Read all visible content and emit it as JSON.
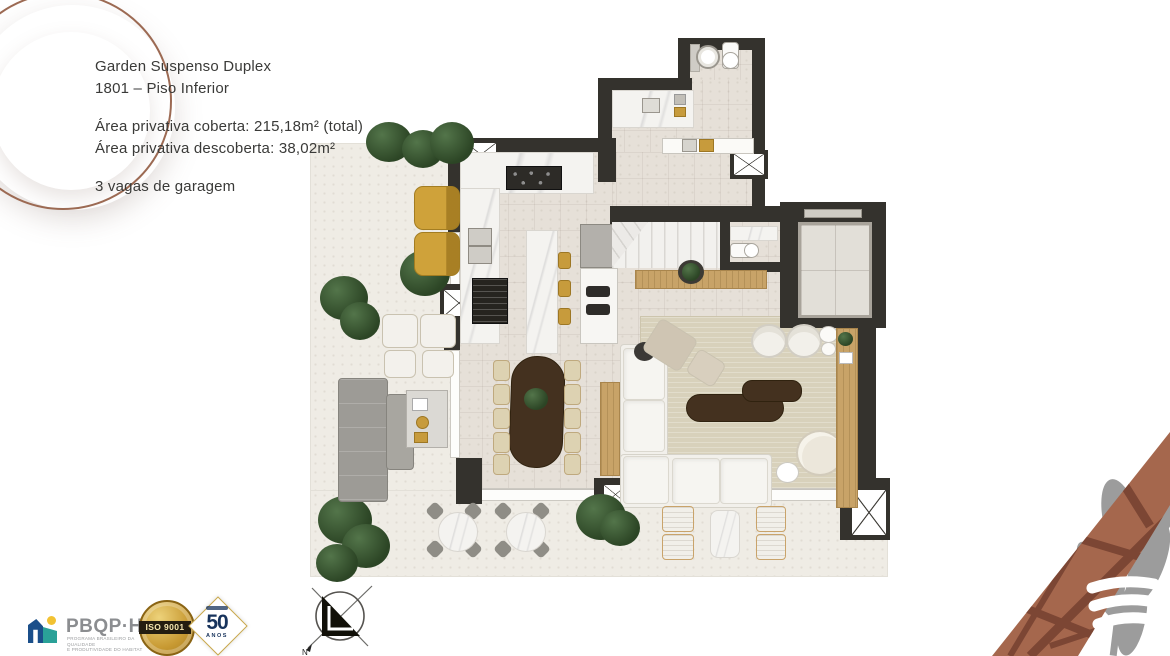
{
  "slide": {
    "info_block": {
      "title_line1": "Garden Suspenso Duplex",
      "title_line2": "1801 – Piso Inferior",
      "area_covered": "Área privativa coberta: 215,18m² (total)",
      "area_uncovered": "Área privativa descoberta: 38,02m²",
      "garage": "3 vagas de garagem"
    },
    "compass": {
      "north_label": "N"
    },
    "badges": {
      "pbqph": {
        "title": "PBQP·H",
        "subtitle_line1": "PROGRAMA BRASILEIRO DA QUALIDADE",
        "subtitle_line2": "E PRODUTIVIDADE DO HABITAT"
      },
      "iso9001": {
        "label": "ISO 9001"
      },
      "fifty_years": {
        "number": "50",
        "label": "ANOS"
      }
    },
    "colors": {
      "wall": "#34322d",
      "indoor_floor": "#e6e0d8",
      "terrace_floor": "#efece5",
      "rug": "#d8d1bb",
      "accent_wood": "#c8a368",
      "dark_wood": "#44311f",
      "lounger_yellow": "#cfa23a",
      "plant_green": "#3a5530",
      "terracotta": "#a5674d",
      "ring_terracotta": "#9c6a53",
      "iso_gold": "#c89a33",
      "navy": "#17335c",
      "brand_blue": "#1b4f8a",
      "brand_teal": "#2aa198",
      "brand_yellow": "#f2c233"
    }
  }
}
